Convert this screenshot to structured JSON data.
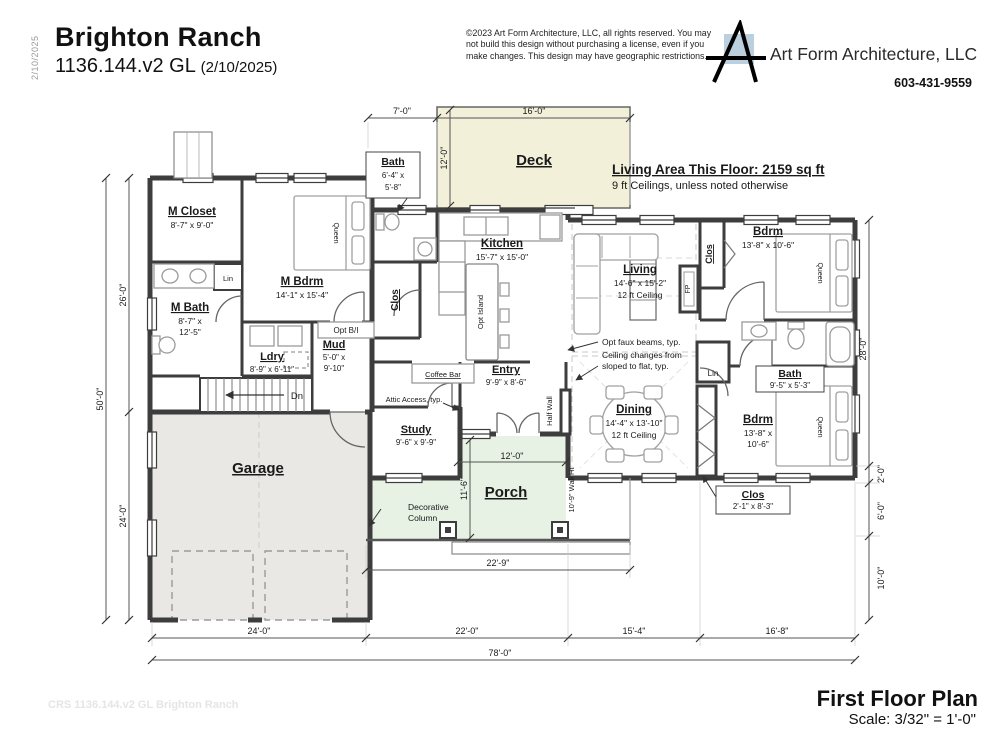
{
  "header": {
    "plan_name": "Brighton Ranch",
    "plan_number": "1136.144.v2 GL",
    "plan_date": "(2/10/2025)",
    "copyright1": "©2023 Art Form Architecture, LLC, all rights reserved. You may",
    "copyright2": "not build this design without purchasing a license, even if you",
    "copyright3": "make changes. This design may have geographic restrictions.",
    "company": "Art Form Architecture, LLC",
    "phone": "603-431-9559"
  },
  "side_date": "2/10/2025",
  "plan_note": {
    "living_area": "Living Area This Floor: 2159 sq ft",
    "ceilings": "9 ft Ceilings, unless noted otherwise"
  },
  "footer": {
    "title": "First Floor Plan",
    "scale": "Scale: 3/32\" = 1'-0\"",
    "watermark": "CRS 1136.144.v2 GL Brighton Ranch"
  },
  "rooms": {
    "m_closet": {
      "name": "M Closet",
      "dims": "8'-7\" x 9'-0\""
    },
    "m_bdrm": {
      "name": "M Bdrm",
      "dims": "14'-1\" x 15'-4\""
    },
    "m_bath": {
      "name": "M Bath",
      "dims1": "8'-7\" x",
      "dims2": "12'-5\""
    },
    "ldry": {
      "name": "Ldry",
      "dims": "8'-9\" x 6'-11\""
    },
    "mud": {
      "name": "Mud",
      "dims1": "5'-0\" x",
      "dims2": "9'-10\""
    },
    "bath_top": {
      "name": "Bath",
      "dims1": "6'-4\" x",
      "dims2": "5'-8\""
    },
    "kitchen": {
      "name": "Kitchen",
      "dims": "15'-7\" x 15'-0\""
    },
    "deck": {
      "name": "Deck"
    },
    "living": {
      "name": "Living",
      "dims": "14'-6\" x 15'-2\"",
      "ceiling": "12 ft Ceiling"
    },
    "dining": {
      "name": "Dining",
      "dims": "14'-4\" x 13'-10\"",
      "ceiling": "12 ft Ceiling"
    },
    "entry": {
      "name": "Entry",
      "dims": "9'-9\" x 8'-6\""
    },
    "study": {
      "name": "Study",
      "dims": "9'-6\" x 9'-9\""
    },
    "porch": {
      "name": "Porch"
    },
    "garage": {
      "name": "Garage"
    },
    "bdrm_tr": {
      "name": "Bdrm",
      "dims": "13'-8\" x 10'-6\""
    },
    "bath_r": {
      "name": "Bath",
      "dims": "9'-5\" x 5'-3\""
    },
    "bdrm_br": {
      "name": "Bdrm",
      "dims1": "13'-8\" x",
      "dims2": "10'-6\""
    },
    "clos_kitchen": {
      "name": "Clos"
    },
    "clos_tr": {
      "name": "Clos"
    },
    "clos_br": {
      "name": "Clos",
      "dims": "2'-1\" x 8'-3\""
    }
  },
  "labels": {
    "lin": "Lin",
    "opt_bi": "Opt B/I",
    "dn": "Dn",
    "coffee_bar": "Coffee Bar",
    "attic_access": "Attic Access, typ.",
    "half_wall": "Half Wall",
    "wall_ht": "10'-9\" Wall Ht",
    "fp": "FP",
    "queen": "Queen",
    "opt_island": "Opt Island",
    "decorative_column1": "Decorative",
    "decorative_column2": "Column",
    "opt_faux_beams": "Opt faux beams, typ.",
    "ceiling_changes1": "Ceiling changes from",
    "ceiling_changes2": "sloped to flat, typ."
  },
  "dims": {
    "top_offset": "7'-0\"",
    "deck_w": "16'-0\"",
    "deck_d": "12'-0\"",
    "left_total": "50'-0\"",
    "left_upper": "26'-0\"",
    "left_lower": "24'-0\"",
    "right_upper": "28'-0\"",
    "right_a": "2'-0\"",
    "right_b": "6'-0\"",
    "right_c": "10'-0\"",
    "bottom_1": "24'-0\"",
    "bottom_2": "22'-0\"",
    "bottom_3": "15'-4\"",
    "bottom_4": "16'-8\"",
    "bottom_total": "78'-0\"",
    "porch_w": "12'-0\"",
    "porch_d": "11'-6\"",
    "porch_total": "22'-9\""
  },
  "colors": {
    "deck_fill": "#f3f0da",
    "porch_fill": "#e7f1e4",
    "garage_fill": "#eae8e4",
    "logo_blue": "#bccfdf"
  }
}
